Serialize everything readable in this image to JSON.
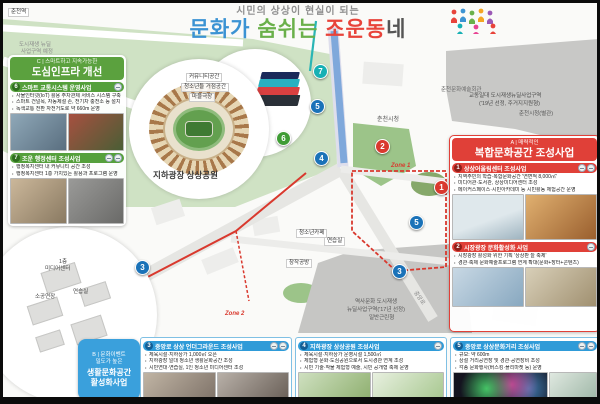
{
  "title": {
    "subtitle": "시민의 상상이 현실이 되는",
    "word1": "문화가",
    "word2": " 숨쉬는 ",
    "word3": "조운동",
    "word4": "네"
  },
  "panel_c": {
    "tag": "C | 스마트하고 지속가능한",
    "title": "도심인프라 개선",
    "projects": [
      {
        "num": "6",
        "title": "스마트 교통시스템 운영사업",
        "bullets": [
          "사물인터넷(IoT) 활용 주차관제 서비스 시스템 구축",
          "스마트 건널목, 자동제설 존, 전기차 충전소 등 설치",
          "녹색교통 전환 자전거도로 약 660m 운영"
        ]
      },
      {
        "num": "7",
        "title": "조운 행정센터 조성사업",
        "bullets": [
          "행정복지센터 내 커뮤니티 공간 조성",
          "행정복지센터 1층 가치있는 활용과 프로그램 운영"
        ]
      }
    ]
  },
  "panel_a": {
    "tag": "A | 매력적인",
    "title": "복합문화공간 조성사업",
    "projects": [
      {
        "num": "1",
        "title": "상상어울림센터 조성사업",
        "bullets": [
          "지역주민의 학습·복합문화공간 '연면적 8,000㎡'",
          "미디어관·도서관, 상상미디어센터 조성",
          "메이커스페이스·시민아카데미 등 시민활동 체험공간 운영"
        ]
      },
      {
        "num": "2",
        "title": "시장광장 문화활성화 사업",
        "bullets": [
          "시장광장 활성화 위한 기획 '상상판 늘 축제'",
          "경관·축제 문화예술프로그램 연계 확대(문화+장터+콘텐츠)"
        ]
      }
    ]
  },
  "panel_b": {
    "tag1": "B | 문화이벤트",
    "tag2": "밀도가 높은",
    "title1": "생활문화공간",
    "title2": "활성화사업",
    "projects": [
      {
        "num": "3",
        "title": "중앙로 상상 언더그라운드 조성사업",
        "bullets": [
          "체육시설·지하상가 1,000㎡ 오픈",
          "지하광장 일대 청소년 생활문화공간 조성",
          "시민연대·연습실, 1인 청소년 미디어센터 조성"
        ]
      },
      {
        "num": "4",
        "title": "지하광장 상상공원 조성사업",
        "bullets": [
          "체육시설·지하상가 운영시설 1,500㎡",
          "체험형 문화·도심공원으로서 도시경관 연계 조성",
          "시민 기술·작물 체험형 예술, 시민 공개형 축제 운영"
        ]
      },
      {
        "num": "5",
        "title": "중앙로 상상문화거리 조성사업",
        "bullets": [
          "규모: 약 600m",
          "상설 거리공연장 및 경관·공연장비 조성",
          "각종 문화행사(버스킹·플리마켓 등) 운영"
        ]
      }
    ]
  },
  "map": {
    "labels": {
      "station": "춘천역",
      "annot1": "도시재생 뉴딜",
      "annot2": "사업구역 예정",
      "community": "커뮤니티공간",
      "youth_space": "청소년들 거점공간",
      "village_theater": "마을극장",
      "plaza": "지하광장 상상공원",
      "gyodong1": "교동일대 도시재생뉴딜사업구역",
      "gyodong2": "('19년 선정, 주거지지원형)",
      "art_hall": "춘천문화예술회관",
      "cityhall_annex": "춘천시청(별관)",
      "cityhall": "춘천시청",
      "youth_cafe": "청소년카페",
      "practice1": "연습실",
      "workshop": "창작공방",
      "floor1": "1층",
      "media_center": "미디어센터",
      "small_hall": "소공연장",
      "practice2": "연습실",
      "history1": "역사문화 도시재생",
      "history2": "뉴딜사업구역('17년 선정)",
      "history3": "일반근린형",
      "zone1": "Zone 1",
      "zone2": "Zone 2",
      "road": "중앙로"
    },
    "markers": [
      {
        "n": "7",
        "x": 310,
        "y": 61,
        "c": "teal"
      },
      {
        "n": "5",
        "x": 307,
        "y": 96,
        "c": "blue"
      },
      {
        "n": "6",
        "x": 273,
        "y": 128,
        "c": "green"
      },
      {
        "n": "4",
        "x": 311,
        "y": 148,
        "c": "blue"
      },
      {
        "n": "2",
        "x": 372,
        "y": 136,
        "c": "red"
      },
      {
        "n": "1",
        "x": 431,
        "y": 177,
        "c": "red"
      },
      {
        "n": "5",
        "x": 406,
        "y": 212,
        "c": "blue"
      },
      {
        "n": "3",
        "x": 389,
        "y": 261,
        "c": "blue"
      },
      {
        "n": "3",
        "x": 132,
        "y": 257,
        "c": "blue"
      }
    ]
  },
  "colors": {
    "section_green": "#5ba13e",
    "section_red": "#e04038",
    "section_blue": "#2f9bd8",
    "marker_teal": "#17b0b4",
    "title_blue": "#3b93d3",
    "title_green": "#6ab04a",
    "title_red": "#e8433a"
  }
}
